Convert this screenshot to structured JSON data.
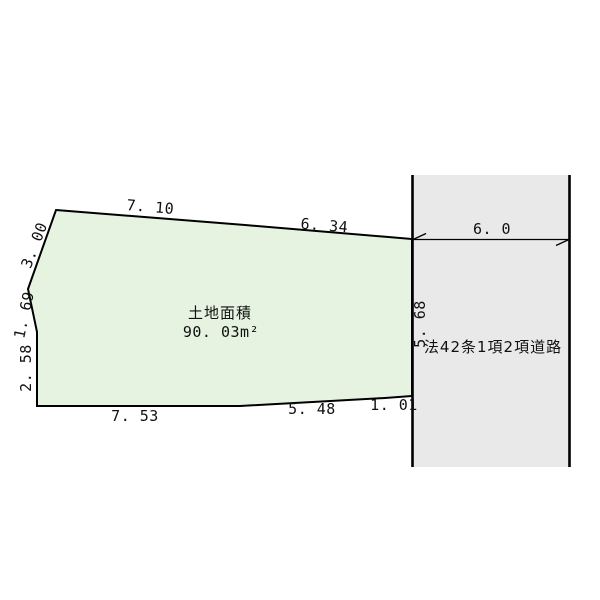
{
  "colors": {
    "parcel_fill": "#e5f3e0",
    "road_fill": "#e9e9e9",
    "line": "#000000"
  },
  "parcel": {
    "area_title": "土地面積",
    "area_value": "90. 03m²",
    "dims": {
      "top1": "7. 10",
      "top2": "6. 34",
      "left_upper": "3. 00",
      "left_middle": "1. 69",
      "left_lower": "2. 58",
      "bottom1": "7. 53",
      "bottom2": "5. 48",
      "bottom3": "1. 01"
    }
  },
  "road": {
    "name": "法42条1項2項道路",
    "frontage": "5. 68",
    "width": "6. 0"
  }
}
